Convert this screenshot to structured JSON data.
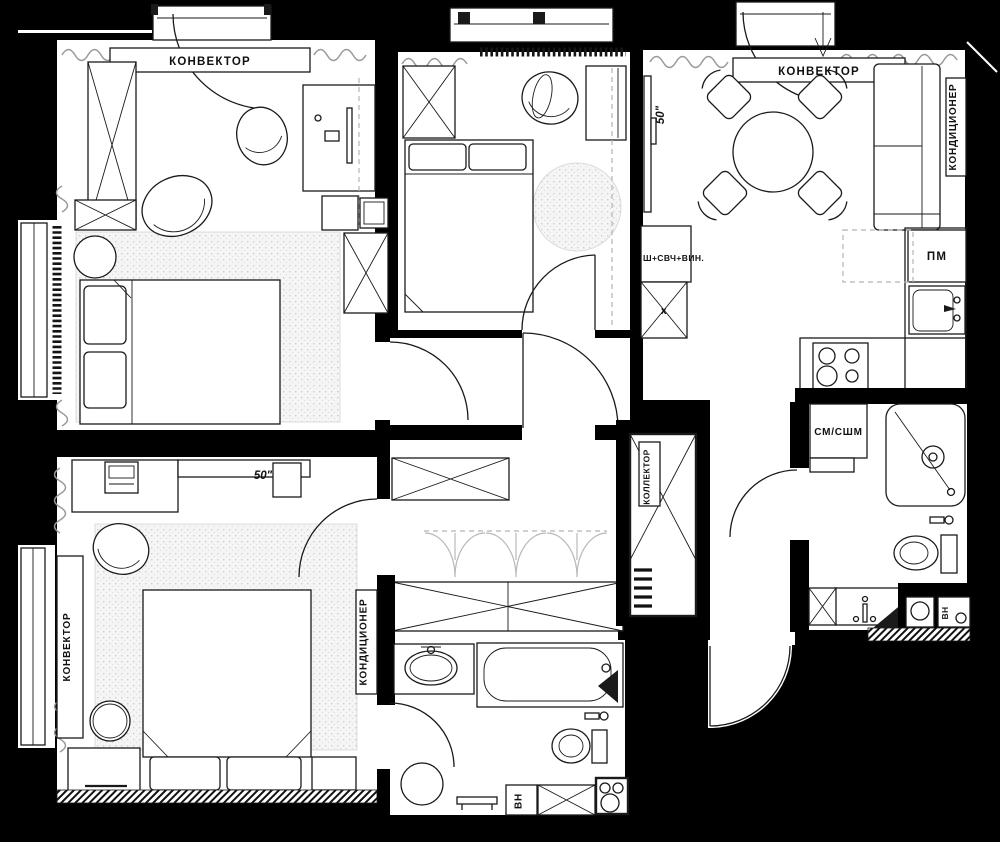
{
  "rooms": {
    "bedroom_top_left": {
      "convector_label": "КОНВЕКТОР"
    },
    "kitchen_living_room": {
      "convector_label": "КОНВЕКТОР",
      "air_conditioner_label": "КОНДИЦИОНЕР",
      "tv_size_label": "50\"",
      "tall_cabinet_label": "Ш+СВЧ+ВИН.",
      "cabinet_mark_label": "х",
      "dishwasher_label": "ПМ"
    },
    "shower_room": {
      "washer_dryer_label": "СМ/СШМ",
      "water_heater_label": "ВН"
    },
    "hallway": {
      "collector_label": "КОЛЛЕКТОР"
    },
    "master_bedroom": {
      "tv_size_label": "50\"",
      "convector_label": "КОНВЕКТОР",
      "air_conditioner_label": "КОНДИЦИОНЕР"
    },
    "bathroom": {
      "water_heater_label": "ВН"
    }
  },
  "colors": {
    "background": "#000000",
    "floor": "#ffffff",
    "line": "#1a1a1a",
    "soft_gray": "#9a9a9a",
    "rug": "#f5f5f5"
  }
}
